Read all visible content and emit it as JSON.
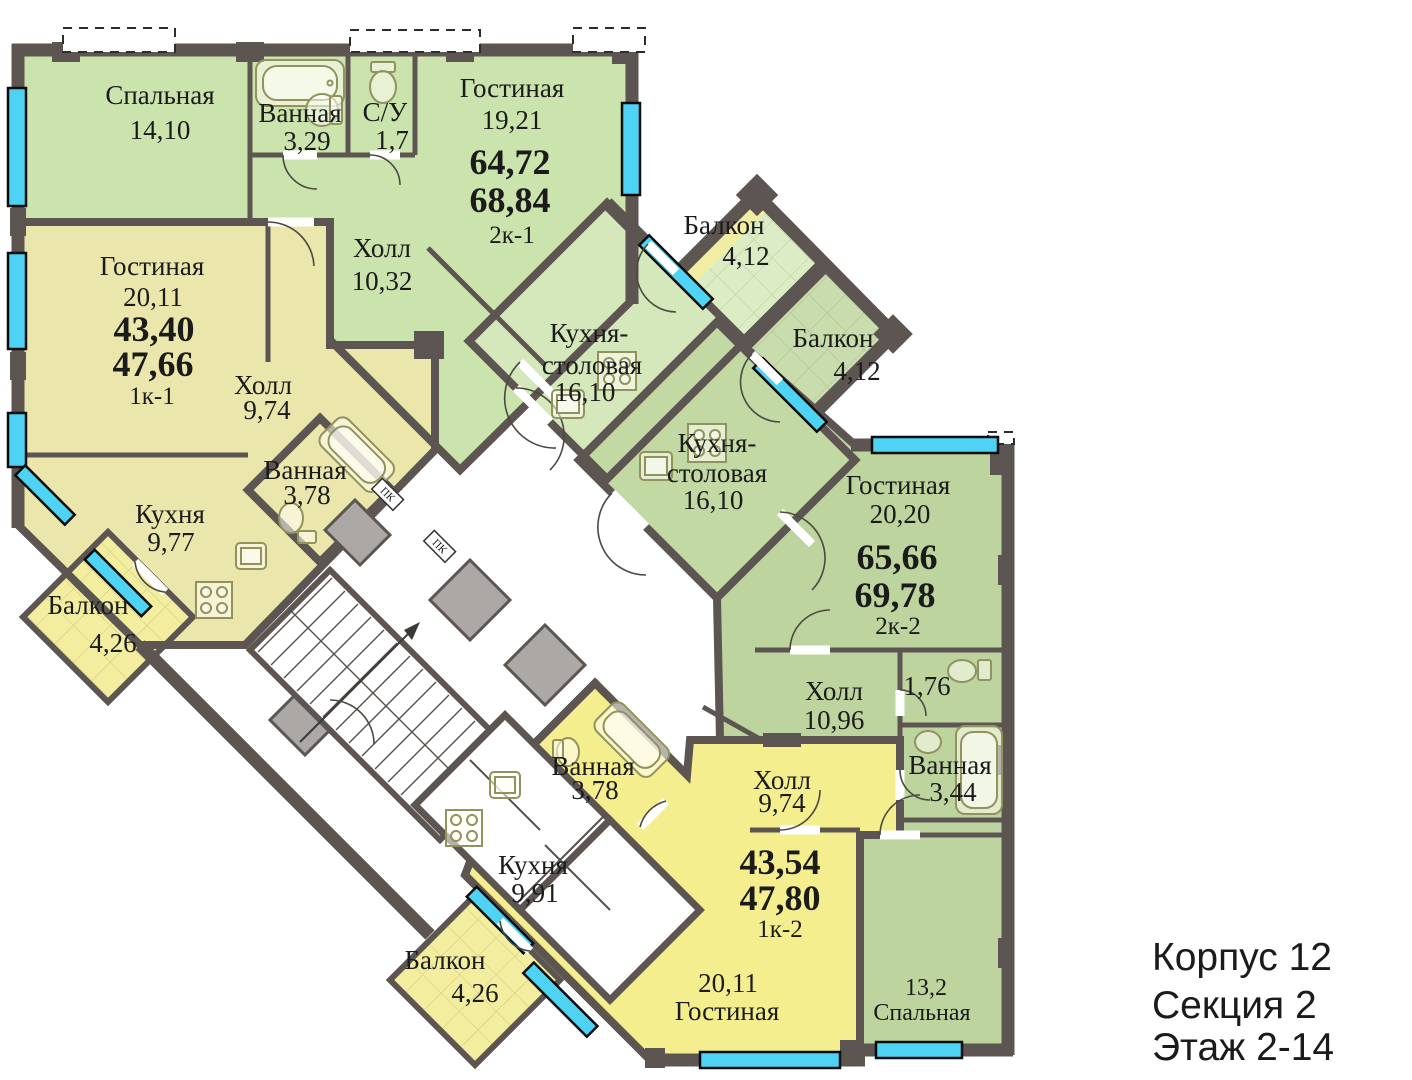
{
  "info": {
    "building": "Корпус 12",
    "section": "Секция 2",
    "floors": "Этаж 2-14"
  },
  "annotations": {
    "pk1": "ПК",
    "pk2": "ПК"
  },
  "apartments": [
    {
      "id": "2k-1",
      "summary": {
        "area_living": "64,72",
        "area_total": "68,84",
        "type": "2к-1"
      },
      "rooms": [
        {
          "name": "Спальная",
          "area": "14,10"
        },
        {
          "name": "Ванная",
          "area": "3,29"
        },
        {
          "name": "С/У",
          "area": "1,7"
        },
        {
          "name": "Гостиная",
          "area": "19,21"
        },
        {
          "name": "Холл",
          "area": "10,32"
        },
        {
          "name1": "Кухня-",
          "name2": "столовая",
          "area": "16,10"
        },
        {
          "name": "Балкон",
          "area": "4,12"
        }
      ]
    },
    {
      "id": "1k-1",
      "summary": {
        "area_living": "43,40",
        "area_total": "47,66",
        "type": "1к-1"
      },
      "rooms": [
        {
          "name": "Гостиная",
          "area": "20,11"
        },
        {
          "name": "Холл",
          "area": "9,74"
        },
        {
          "name": "Ванная",
          "area": "3,78"
        },
        {
          "name": "Кухня",
          "area": "9,77"
        },
        {
          "name": "Балкон",
          "area": "4,26"
        }
      ]
    },
    {
      "id": "2k-2",
      "summary": {
        "area_living": "65,66",
        "area_total": "69,78",
        "type": "2к-2"
      },
      "rooms": [
        {
          "name1": "Кухня-",
          "name2": "столовая",
          "area": "16,10"
        },
        {
          "name": "Балкон",
          "area": "4,12"
        },
        {
          "name": "Гостиная",
          "area": "20,20"
        },
        {
          "name": "Холл",
          "area": "10,96"
        },
        {
          "area": "1,76"
        },
        {
          "name": "Ванная",
          "area": "3,44"
        },
        {
          "name": "Спальная",
          "area": "13,2"
        }
      ]
    },
    {
      "id": "1k-2",
      "summary": {
        "area_living": "43,54",
        "area_total": "47,80",
        "type": "1к-2"
      },
      "rooms": [
        {
          "name": "Ванная",
          "area": "3,78"
        },
        {
          "name": "Холл",
          "area": "9,74"
        },
        {
          "name": "Кухня",
          "area": "9,91"
        },
        {
          "name": "Гостиная",
          "area": "20,11"
        },
        {
          "name": "Балкон",
          "area": "4,26"
        }
      ]
    }
  ],
  "colors": {
    "wall": "#5d5551",
    "text": "#1b1b1b",
    "green1": "#cbe3ac",
    "green1b": "#d4e8bb",
    "balc1": "#dcedc6",
    "olive": "#bdd49e",
    "balc2": "#c9dcad",
    "yellow1": "#ebe6ac",
    "yellow2": "#f5ee8e",
    "tileyellow": "#f3eda0",
    "window": "#4ed3f5",
    "fixture": "#92925e"
  }
}
